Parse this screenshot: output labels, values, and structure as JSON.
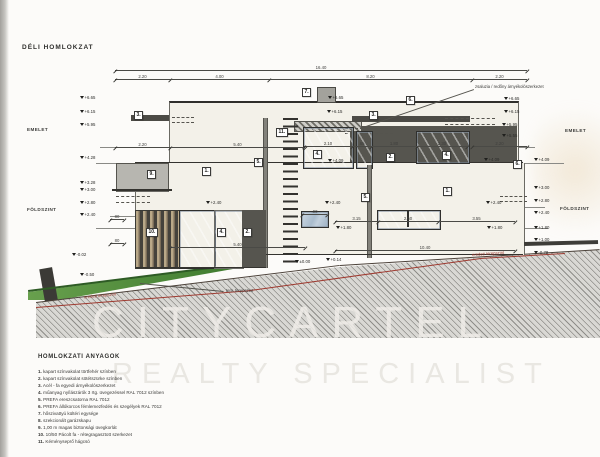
{
  "title": "DÉLI HOMLOKZAT",
  "floors": {
    "emelet": "EMELET",
    "foldszint": "FÖLDSZINT"
  },
  "annotations": {
    "shade_note": "zsaluzia / redőny árnyékolószerkezet",
    "terrain_planned": "terv. terepszint",
    "terrain_original": "eredeti terepszint"
  },
  "colors": {
    "paper": "#fcfbf9",
    "wall": "#f3f1e9",
    "dark_panel": "#56554f",
    "glass": "#aebfd3",
    "timber": "#b9a888",
    "grass": "#4f8f3c",
    "terrain_red": "#9e3a30",
    "hatch": "#d9d8d4"
  },
  "markers": [
    {
      "label": "3."
    },
    {
      "label": "7."
    },
    {
      "label": "6."
    },
    {
      "label": "3."
    },
    {
      "label": "11."
    },
    {
      "label": "5."
    },
    {
      "label": "9."
    },
    {
      "label": "1."
    },
    {
      "label": "4."
    },
    {
      "label": "2."
    },
    {
      "label": "4."
    },
    {
      "label": "6."
    },
    {
      "label": "1."
    },
    {
      "label": "5."
    },
    {
      "label": "10."
    },
    {
      "label": "4."
    },
    {
      "label": "2."
    }
  ],
  "elevations": [
    {
      "v": "+6.65"
    },
    {
      "v": "+6.15"
    },
    {
      "v": "+5.95"
    },
    {
      "v": "+4.28"
    },
    {
      "v": "+3.28"
    },
    {
      "v": "+3.00"
    },
    {
      "v": "+2.80"
    },
    {
      "v": "+2.40"
    },
    {
      "v": "-0.02"
    },
    {
      "v": "-0.50"
    },
    {
      "v": "+6.65"
    },
    {
      "v": "+6.15"
    },
    {
      "v": "+4.09"
    },
    {
      "v": "+2.40"
    },
    {
      "v": "+2.40"
    },
    {
      "v": "+1.80"
    },
    {
      "v": "±0.00"
    },
    {
      "v": "+0.14"
    },
    {
      "v": "+6.65"
    },
    {
      "v": "+6.15"
    },
    {
      "v": "+5.95"
    },
    {
      "v": "+5.55"
    },
    {
      "v": "+4.09"
    },
    {
      "v": "+2.40"
    },
    {
      "v": "+1.80"
    },
    {
      "v": "+4.09"
    },
    {
      "v": "+3.00"
    },
    {
      "v": "+2.80"
    },
    {
      "v": "+2.40"
    },
    {
      "v": "+1.80"
    },
    {
      "v": "+1.00"
    },
    {
      "v": "-0.78"
    }
  ],
  "dims": [
    {
      "v": "16.40"
    },
    {
      "v": "2.20"
    },
    {
      "v": "4.00"
    },
    {
      "v": "8.20"
    },
    {
      "v": "2.20"
    },
    {
      "v": "2.20"
    },
    {
      "v": "5.40"
    },
    {
      "v": "2.10"
    },
    {
      "v": ".65"
    },
    {
      "v": "1.80"
    },
    {
      "v": "2.30"
    },
    {
      "v": "2.20"
    },
    {
      "v": "3.15"
    },
    {
      "v": "2.60"
    },
    {
      "v": "3.55"
    },
    {
      "v": "5.40"
    },
    {
      "v": "10.40"
    },
    {
      "v": "80"
    },
    {
      "v": "80"
    },
    {
      "v": ".90"
    }
  ],
  "legend": {
    "title": "HOMLOKZATI ANYAGOK",
    "items": [
      {
        "n": "1.",
        "t": "kapart színvakolat törtfehér színben"
      },
      {
        "n": "2.",
        "t": "kapart színvakolat sötétszürke színben"
      },
      {
        "n": "3.",
        "t": "Acél - fa egyedi árnyékolószerkezet"
      },
      {
        "n": "4.",
        "t": "műanyag nyílászárók 3 rtg. üvegezéssel RAL 7012 színben"
      },
      {
        "n": "5.",
        "t": "PREFA ereszcsatorna RAL 7012"
      },
      {
        "n": "6.",
        "t": "PREFA állókorcos fémlemezfedés és szegélyek RAL 7012"
      },
      {
        "n": "7.",
        "t": "hőszivattyú kültéri egysége"
      },
      {
        "n": "8.",
        "t": "szekcionált garázskapu"
      },
      {
        "n": "9.",
        "t": "1,00 m magas biztonsági üvegkorlát"
      },
      {
        "n": "10.",
        "t": "10/50 Pácolt fa - rétegragasztott szerkezet"
      },
      {
        "n": "11.",
        "t": "Kéményseprő hágcsó"
      }
    ]
  },
  "watermark": {
    "line1": "CITYCARTEL",
    "line2": "REALTY SPECIALIST"
  }
}
